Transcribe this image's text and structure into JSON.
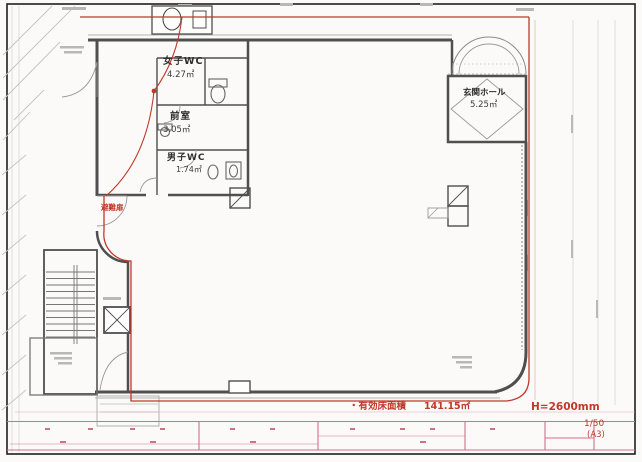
{
  "rooms": [
    {
      "name": "女子WC",
      "area": "4.27㎡"
    },
    {
      "name": "前室",
      "area": "3.05㎡"
    },
    {
      "name": "男子WC",
      "area": "1.74㎡"
    },
    {
      "name": "玄関ホール",
      "area": "5.25㎡"
    }
  ],
  "annotations": {
    "evacuation_door": "避難扉",
    "floor_area_label": "・有効床面積",
    "floor_area_value": "141.15㎡",
    "ceiling_height": "H=2600mm",
    "scale": "1/50",
    "sheet_size": "(A3)"
  },
  "colors": {
    "boundary_red": "#c0392b",
    "dimension_pink": "#cf7288",
    "wall_gray": "#4f4f4f",
    "light_gray": "#c9c9c6",
    "text_dark": "#2e2e2e"
  }
}
